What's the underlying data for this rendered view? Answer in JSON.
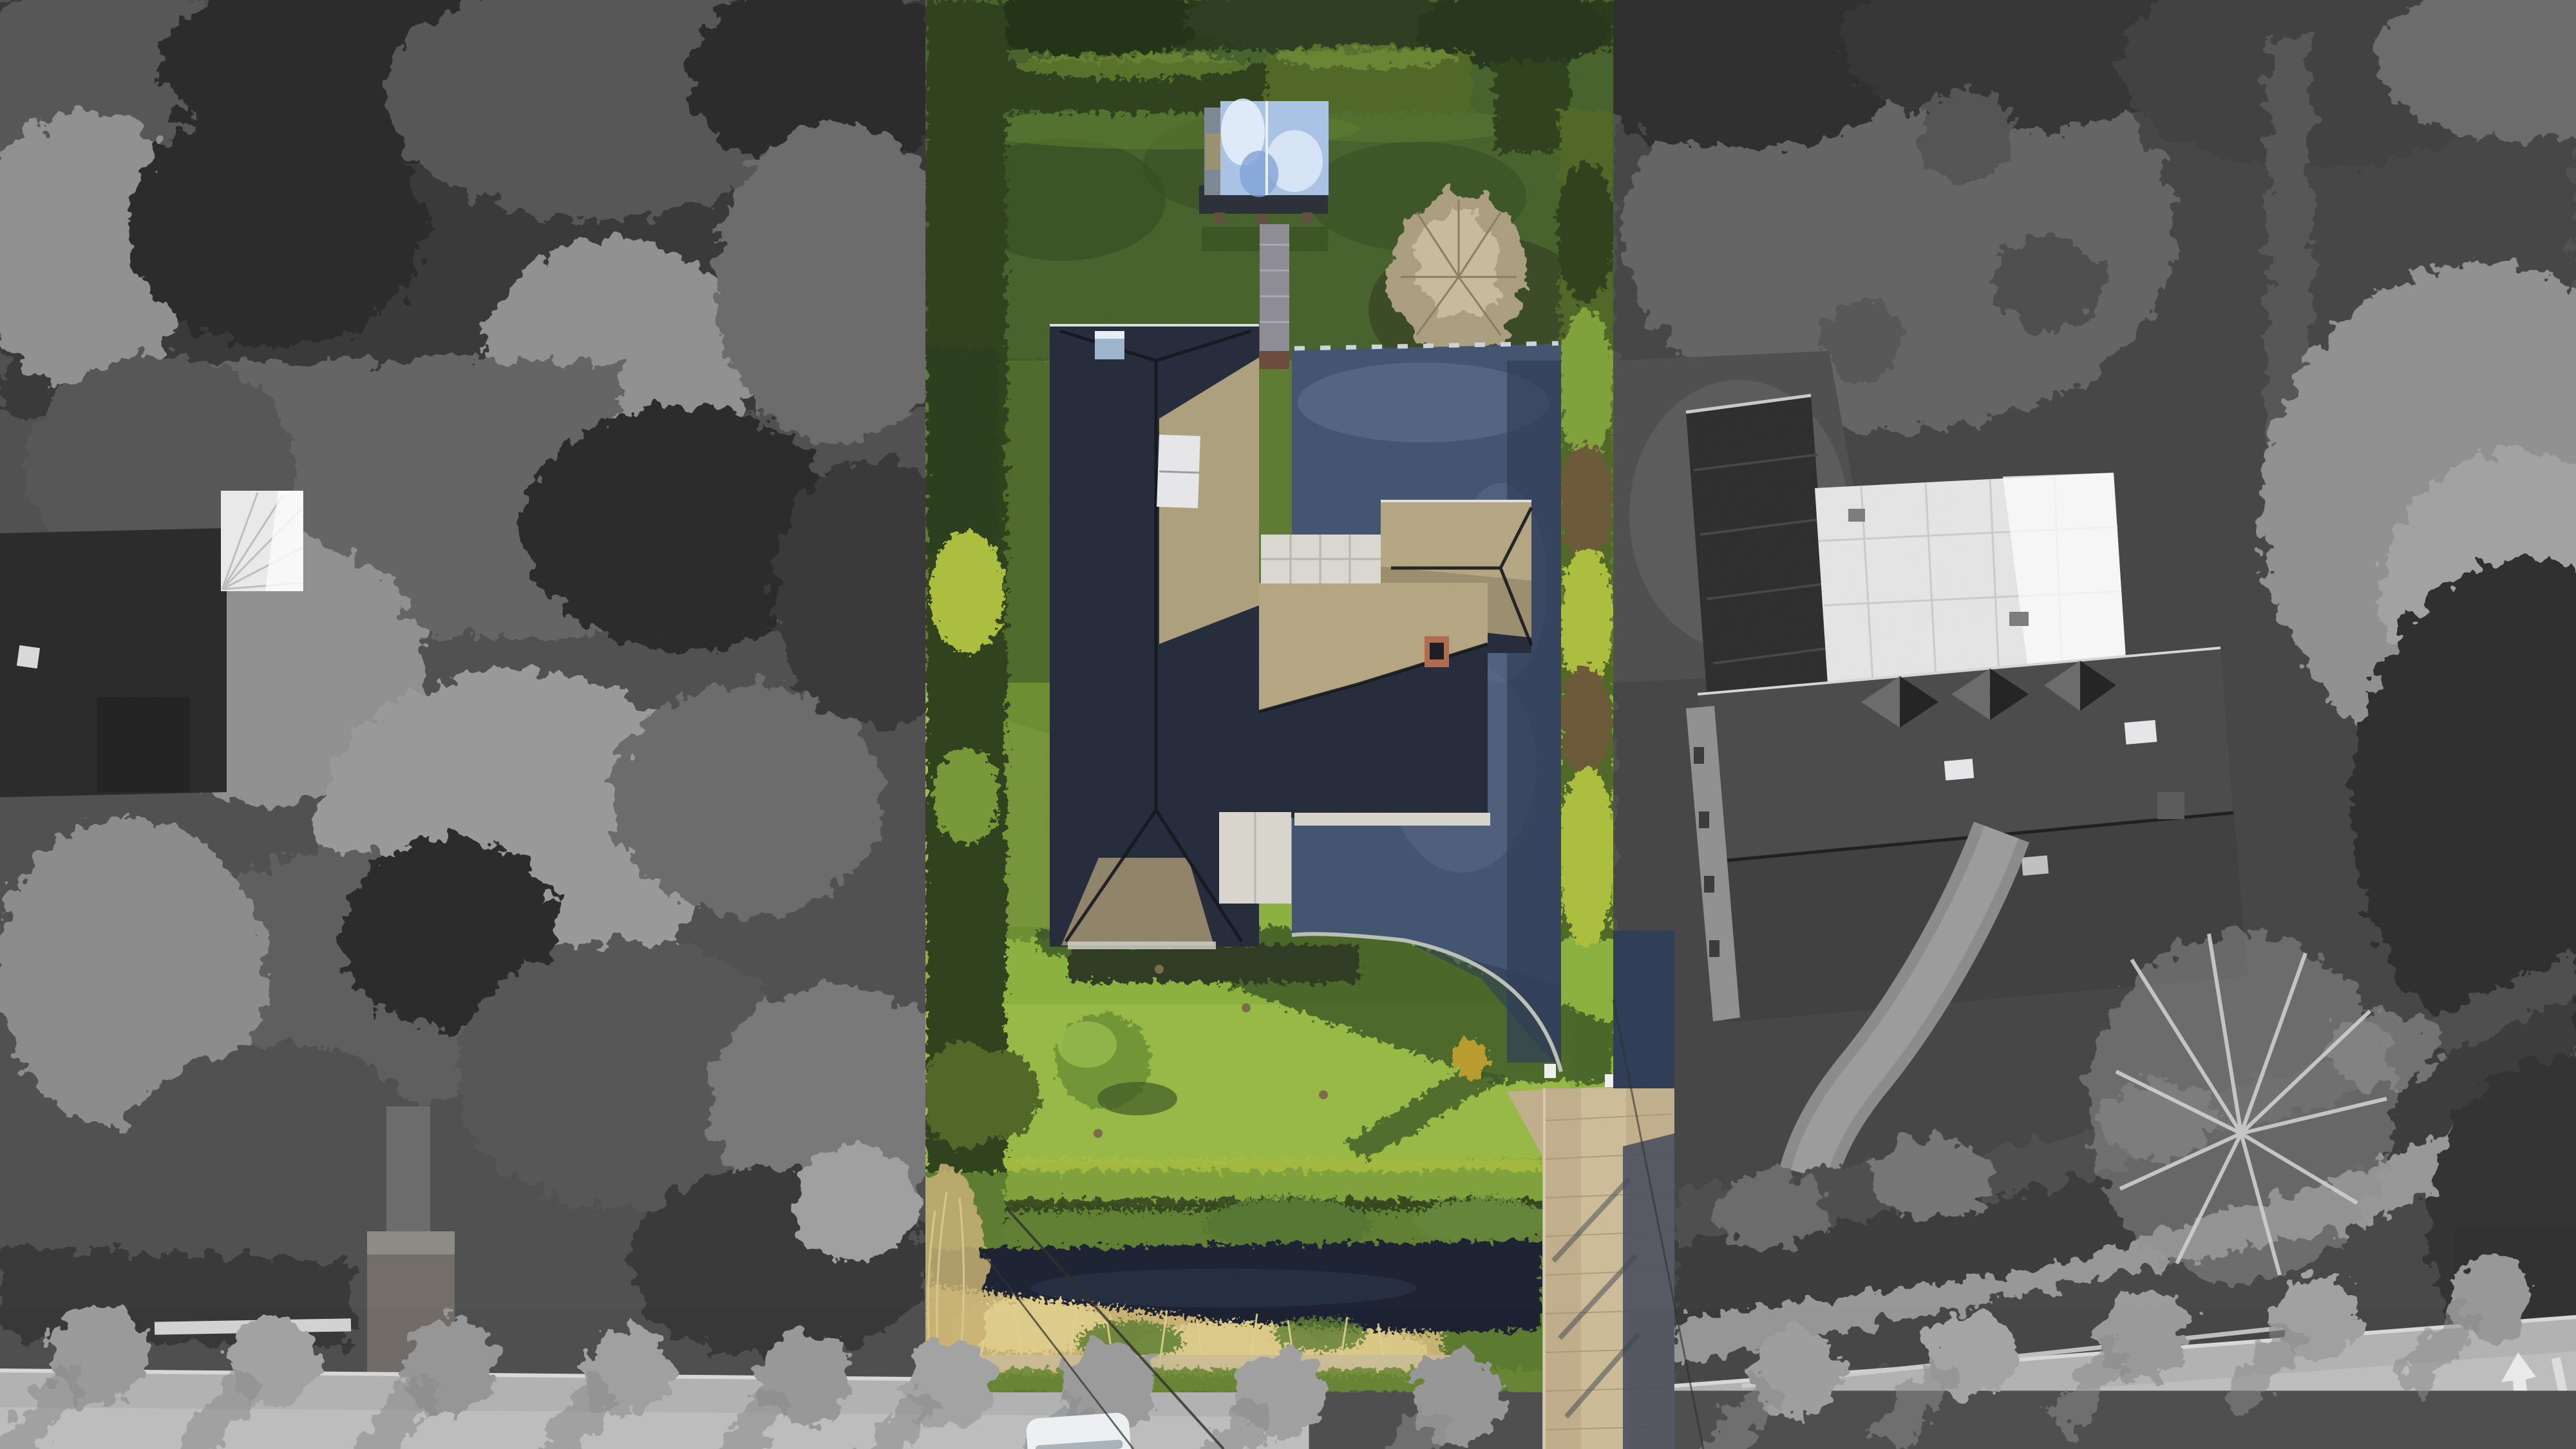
{
  "scene": {
    "kind": "aerial-drone-photograph",
    "subject": "residential-parcel-highlighted-in-color-over-grayscale-surroundings",
    "orientation": "top-down",
    "text_visible": ""
  },
  "palette": {
    "gray_base": "#4f4f4f",
    "woods_dark": "#2b2b2b",
    "woods_dark2": "#383838",
    "woods_mid": "#555555",
    "woods_mid2": "#6b6b6b",
    "woods_light": "#8f8f8f",
    "woods_bright": "#a8a8a8",
    "meadow_gray": "#646464",
    "meadow_dark": "#454545",
    "flat_roof": "#2a2a2a",
    "conservatory_white": "#e9e9e9",
    "terrace_white": "#e3e3e3",
    "roof_gray": "#3f3f3f",
    "roof_gray_dark": "#2d2d2d",
    "roof_gray_light": "#4a4a4a",
    "facade_gray": "#8f8f8f",
    "drive_gray": "#4e4e4e",
    "drive_gray_light": "#9a9a9a",
    "road_gray": "#b2b2b2",
    "road_light": "#bdbdbd",
    "road_shadow": "#8a8a8a",
    "curb_light": "#d8d8d8",
    "car_white": "#edf0f2",
    "stream_gray": "#3a3a3a",
    "bank_gray": "#a0a0a0",
    "branch_white": "#cdcdcd",
    "brick_gray": "#716c67",
    "wall_light": "#d2d2d2",
    "lawn_top": "#47612c",
    "lawn_mid": "#5d7a31",
    "lawn_bright": "#8ab03e",
    "lawn_sun": "#a6c44e",
    "shadow_green": "#33491f",
    "shadow_green2": "#3d5726",
    "hedge_dark": "#2e401f",
    "hedge_mid": "#4f6628",
    "hedge_light": "#7fa03a",
    "hedge_lime": "#aabd3d",
    "hedge_brown": "#6b5838",
    "mulch_dark": "#3a4a26",
    "topiary_green": "#6f9434",
    "topiary_light": "#93b84a",
    "bush_yellow": "#b89b2e",
    "roof_dark": "#252b3a",
    "roof_tan": "#b3a580",
    "roof_tan2": "#9a8d6e",
    "ridge_dark": "#14161d",
    "skylight_white": "#e6e6e8",
    "chimney_blue": "#9db3cc",
    "chimney_brick": "#b06a4c",
    "courtyard_tile": "#d9d6cf",
    "terrace_tile": "#d7d4cc",
    "shed_roof_blue": "#a9c2e4",
    "shed_roof_white": "#e8f1fb",
    "shed_roof_blue2": "#7fa3d4",
    "shed_eave": "#2b2f38",
    "shed_side_tan": "#9a9070",
    "path_brick": "#8c8a93",
    "drive_blue": "#42536f",
    "drive_blue_light": "#5a6b88",
    "drive_blue_dark": "#2f3c55",
    "water_dark": "#1c2431",
    "reed_tan": "#c7b173",
    "reed_light": "#e0d08f",
    "scrub_green": "#5f7e33",
    "bank_stone": "#cabb97",
    "paver_tan": "#c0ad8b",
    "paver_light": "#d4c4a0",
    "paver_shadow": "#42495a",
    "post_white": "#eef0ee",
    "wire_dark": "#2e3129"
  }
}
